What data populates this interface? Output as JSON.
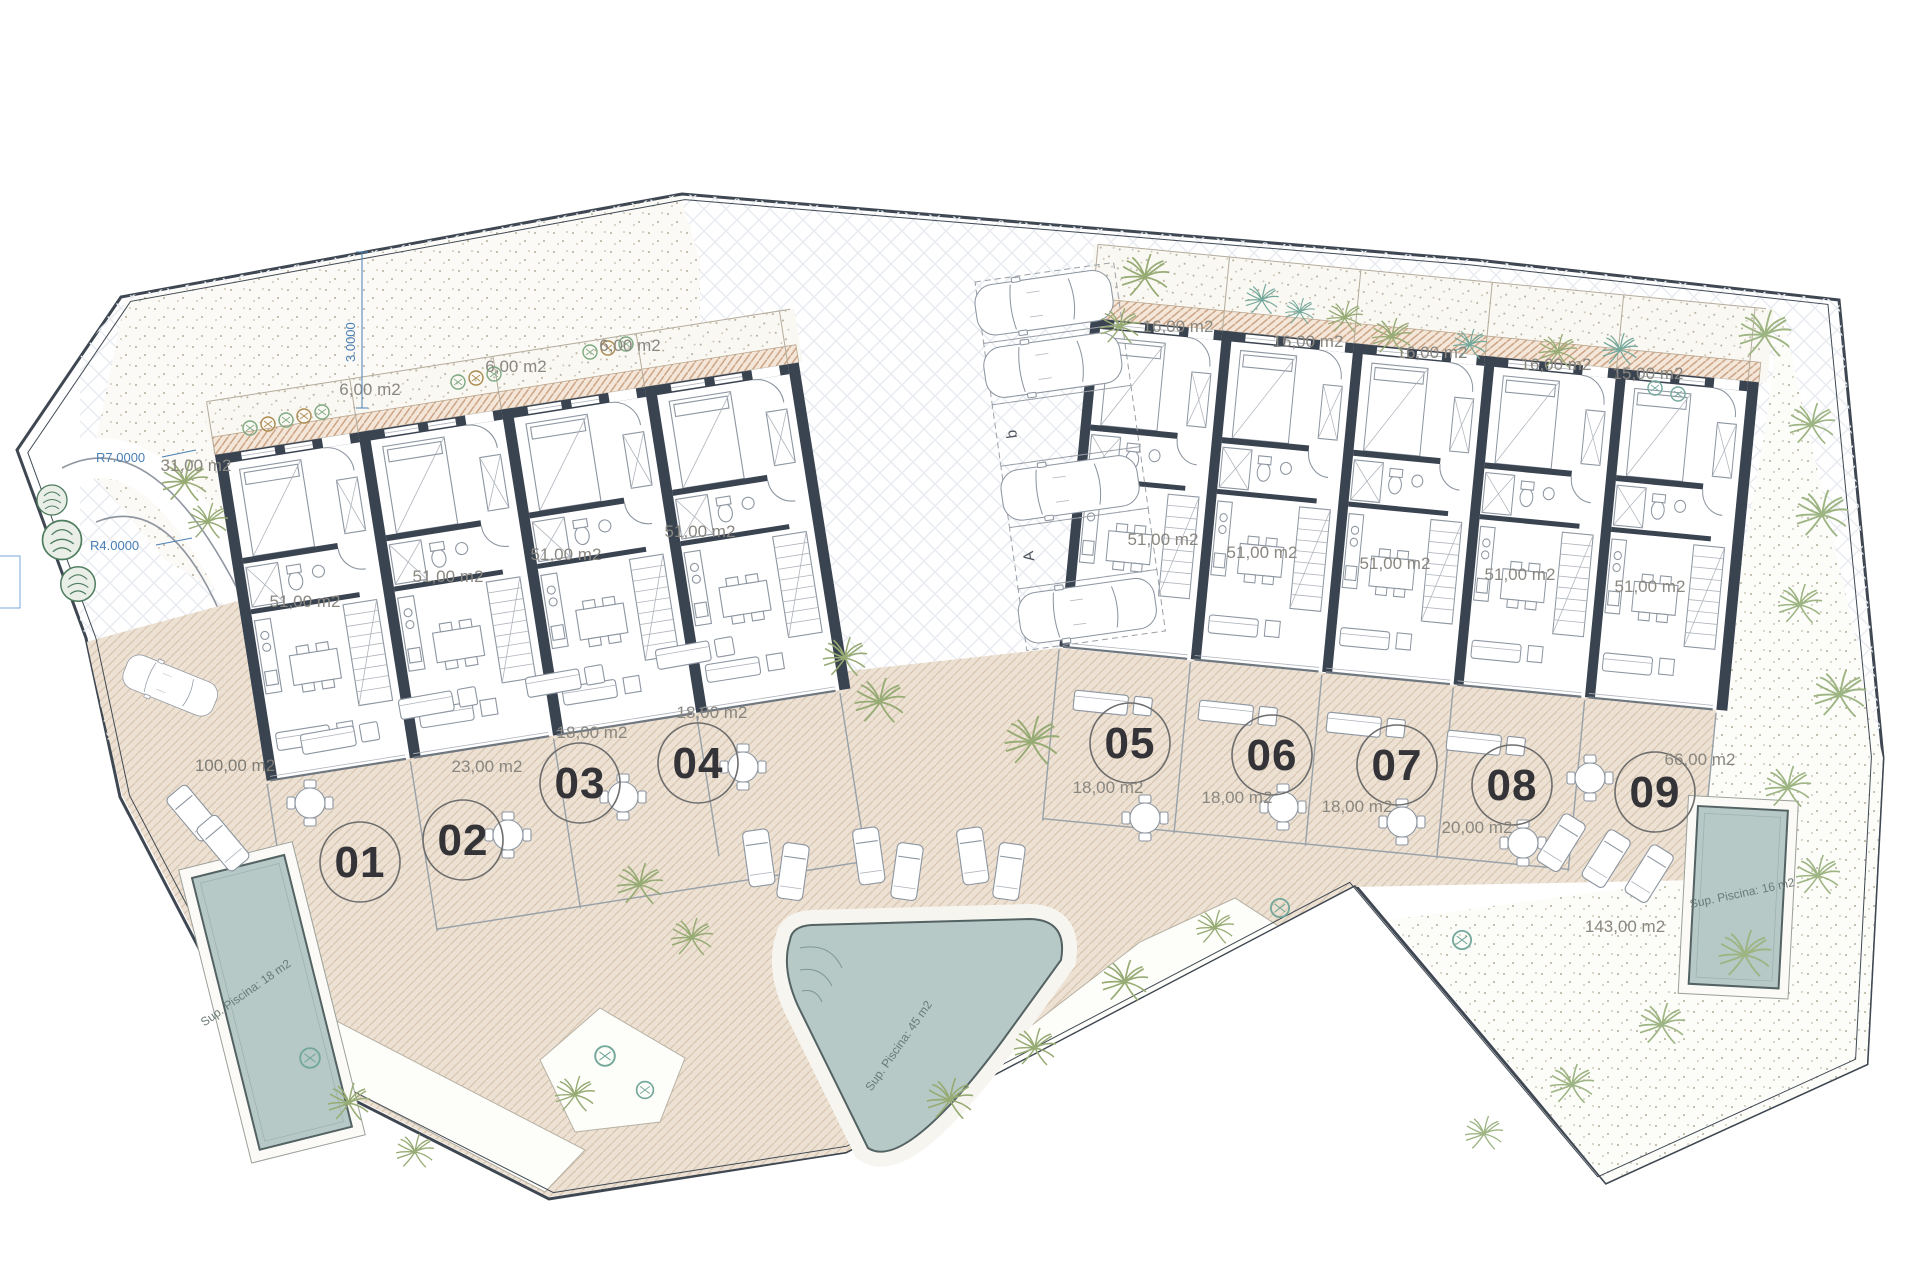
{
  "plan_type": "residential site plan",
  "colors": {
    "wall": "#3a4350",
    "pool_water": "#b7c9c6",
    "paving_beige": "#ece1d3",
    "entry_hatch": "#c99f80",
    "dimension_blue": "#4a7fb5",
    "palm_green": "#97ab74",
    "teal_shrub": "#74a89b",
    "boundary": "#3f4852"
  },
  "units": [
    {
      "number": "01",
      "interior_area": "51,00 m2",
      "terrace_area": "100,00 m2"
    },
    {
      "number": "02",
      "interior_area": "51,00 m2",
      "terrace_area": "23,00 m2",
      "garden_area": "6,00 m2"
    },
    {
      "number": "03",
      "interior_area": "51,00 m2",
      "terrace_area": "18,00 m2",
      "garden_area": "6,00 m2"
    },
    {
      "number": "04",
      "interior_area": "51,00 m2",
      "terrace_area": "18,00 m2",
      "garden_area": "6,00 m2"
    },
    {
      "number": "05",
      "interior_area": "51,00 m2",
      "terrace_area": "18,00 m2",
      "garden_area": "16,00 m2"
    },
    {
      "number": "06",
      "interior_area": "51,00 m2",
      "terrace_area": "18,00 m2",
      "garden_area": "16,00 m2"
    },
    {
      "number": "07",
      "interior_area": "51,00 m2",
      "terrace_area": "18,00 m2",
      "garden_area": "16,00 m2"
    },
    {
      "number": "08",
      "interior_area": "51,00 m2",
      "terrace_area": "20,00 m2",
      "garden_area": "16,00 m2"
    },
    {
      "number": "09",
      "interior_area": "51,00 m2",
      "terrace_area": "66,00 m2",
      "garden_area": "15,00 m2"
    }
  ],
  "site_labels": {
    "left_bed_area": "31,00 m2",
    "right_garden_area": "143,00 m2"
  },
  "pools": [
    {
      "id": "pool-unit-01",
      "label": "Sup. Piscina: 18 m2"
    },
    {
      "id": "pool-communal",
      "label": "Sup. Piscina: 45 m2"
    },
    {
      "id": "pool-unit-09",
      "label": "Sup. Piscina: 16 m2"
    }
  ],
  "dimensions": {
    "offset": "3.0000",
    "radius_outer": "R7.0000",
    "radius_inner": "R4.0000"
  },
  "parking": {
    "stall_b": "b",
    "stall_a": "A"
  }
}
